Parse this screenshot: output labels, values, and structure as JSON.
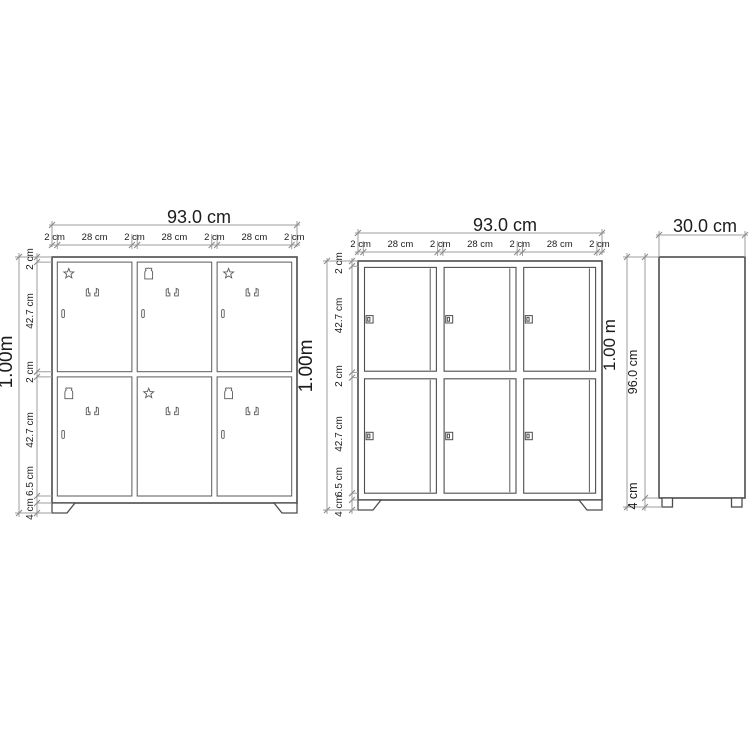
{
  "diagram": {
    "background": "#ffffff",
    "colors": {
      "outline": "#4d4d4d",
      "dim_line": "#9e9e9e",
      "text": "#1c1c1c"
    },
    "figures": [
      {
        "name": "front-view-open",
        "width_dim": "93.0 cm",
        "height_dim": "1.00m",
        "top_segments": [
          "2 cm",
          "28 cm",
          "2 cm",
          "28 cm",
          "2 cm",
          "28 cm",
          "2 cm"
        ],
        "side_segments": [
          "2 cm",
          "42.7 cm",
          "2 cm",
          "42.7 cm",
          "6.5 cm",
          "4 cm"
        ],
        "compartments": [
          {
            "row": 1,
            "col": 1,
            "decor": "star",
            "hook_pair": true,
            "wall_hook": true
          },
          {
            "row": 1,
            "col": 2,
            "decor": "crown",
            "hook_pair": true,
            "wall_hook": true
          },
          {
            "row": 1,
            "col": 3,
            "decor": "star",
            "hook_pair": true,
            "wall_hook": true
          },
          {
            "row": 2,
            "col": 1,
            "decor": "crown",
            "hook_pair": true,
            "wall_hook": true
          },
          {
            "row": 2,
            "col": 2,
            "decor": "star",
            "hook_pair": true,
            "wall_hook": false
          },
          {
            "row": 2,
            "col": 3,
            "decor": "crown",
            "hook_pair": true,
            "wall_hook": true
          }
        ]
      },
      {
        "name": "front-view-with-doors",
        "width_dim": "93.0 cm",
        "height_dim": "1.00m",
        "top_segments": [
          "2 cm",
          "28 cm",
          "2 cm",
          "28 cm",
          "2 cm",
          "28 cm",
          "2 cm"
        ],
        "side_segments": [
          "2 cm",
          "42.7 cm",
          "2 cm",
          "42.7 cm",
          "6.5 cm",
          "4 cm"
        ],
        "doors": {
          "rows": 2,
          "cols": 3,
          "count": 6,
          "handle_side": "left"
        }
      },
      {
        "name": "side-view",
        "width_dim": "30.0 cm",
        "height_dim": "1.00 m",
        "side_segments": [
          "96.0 cm",
          "4 cm"
        ]
      }
    ]
  }
}
